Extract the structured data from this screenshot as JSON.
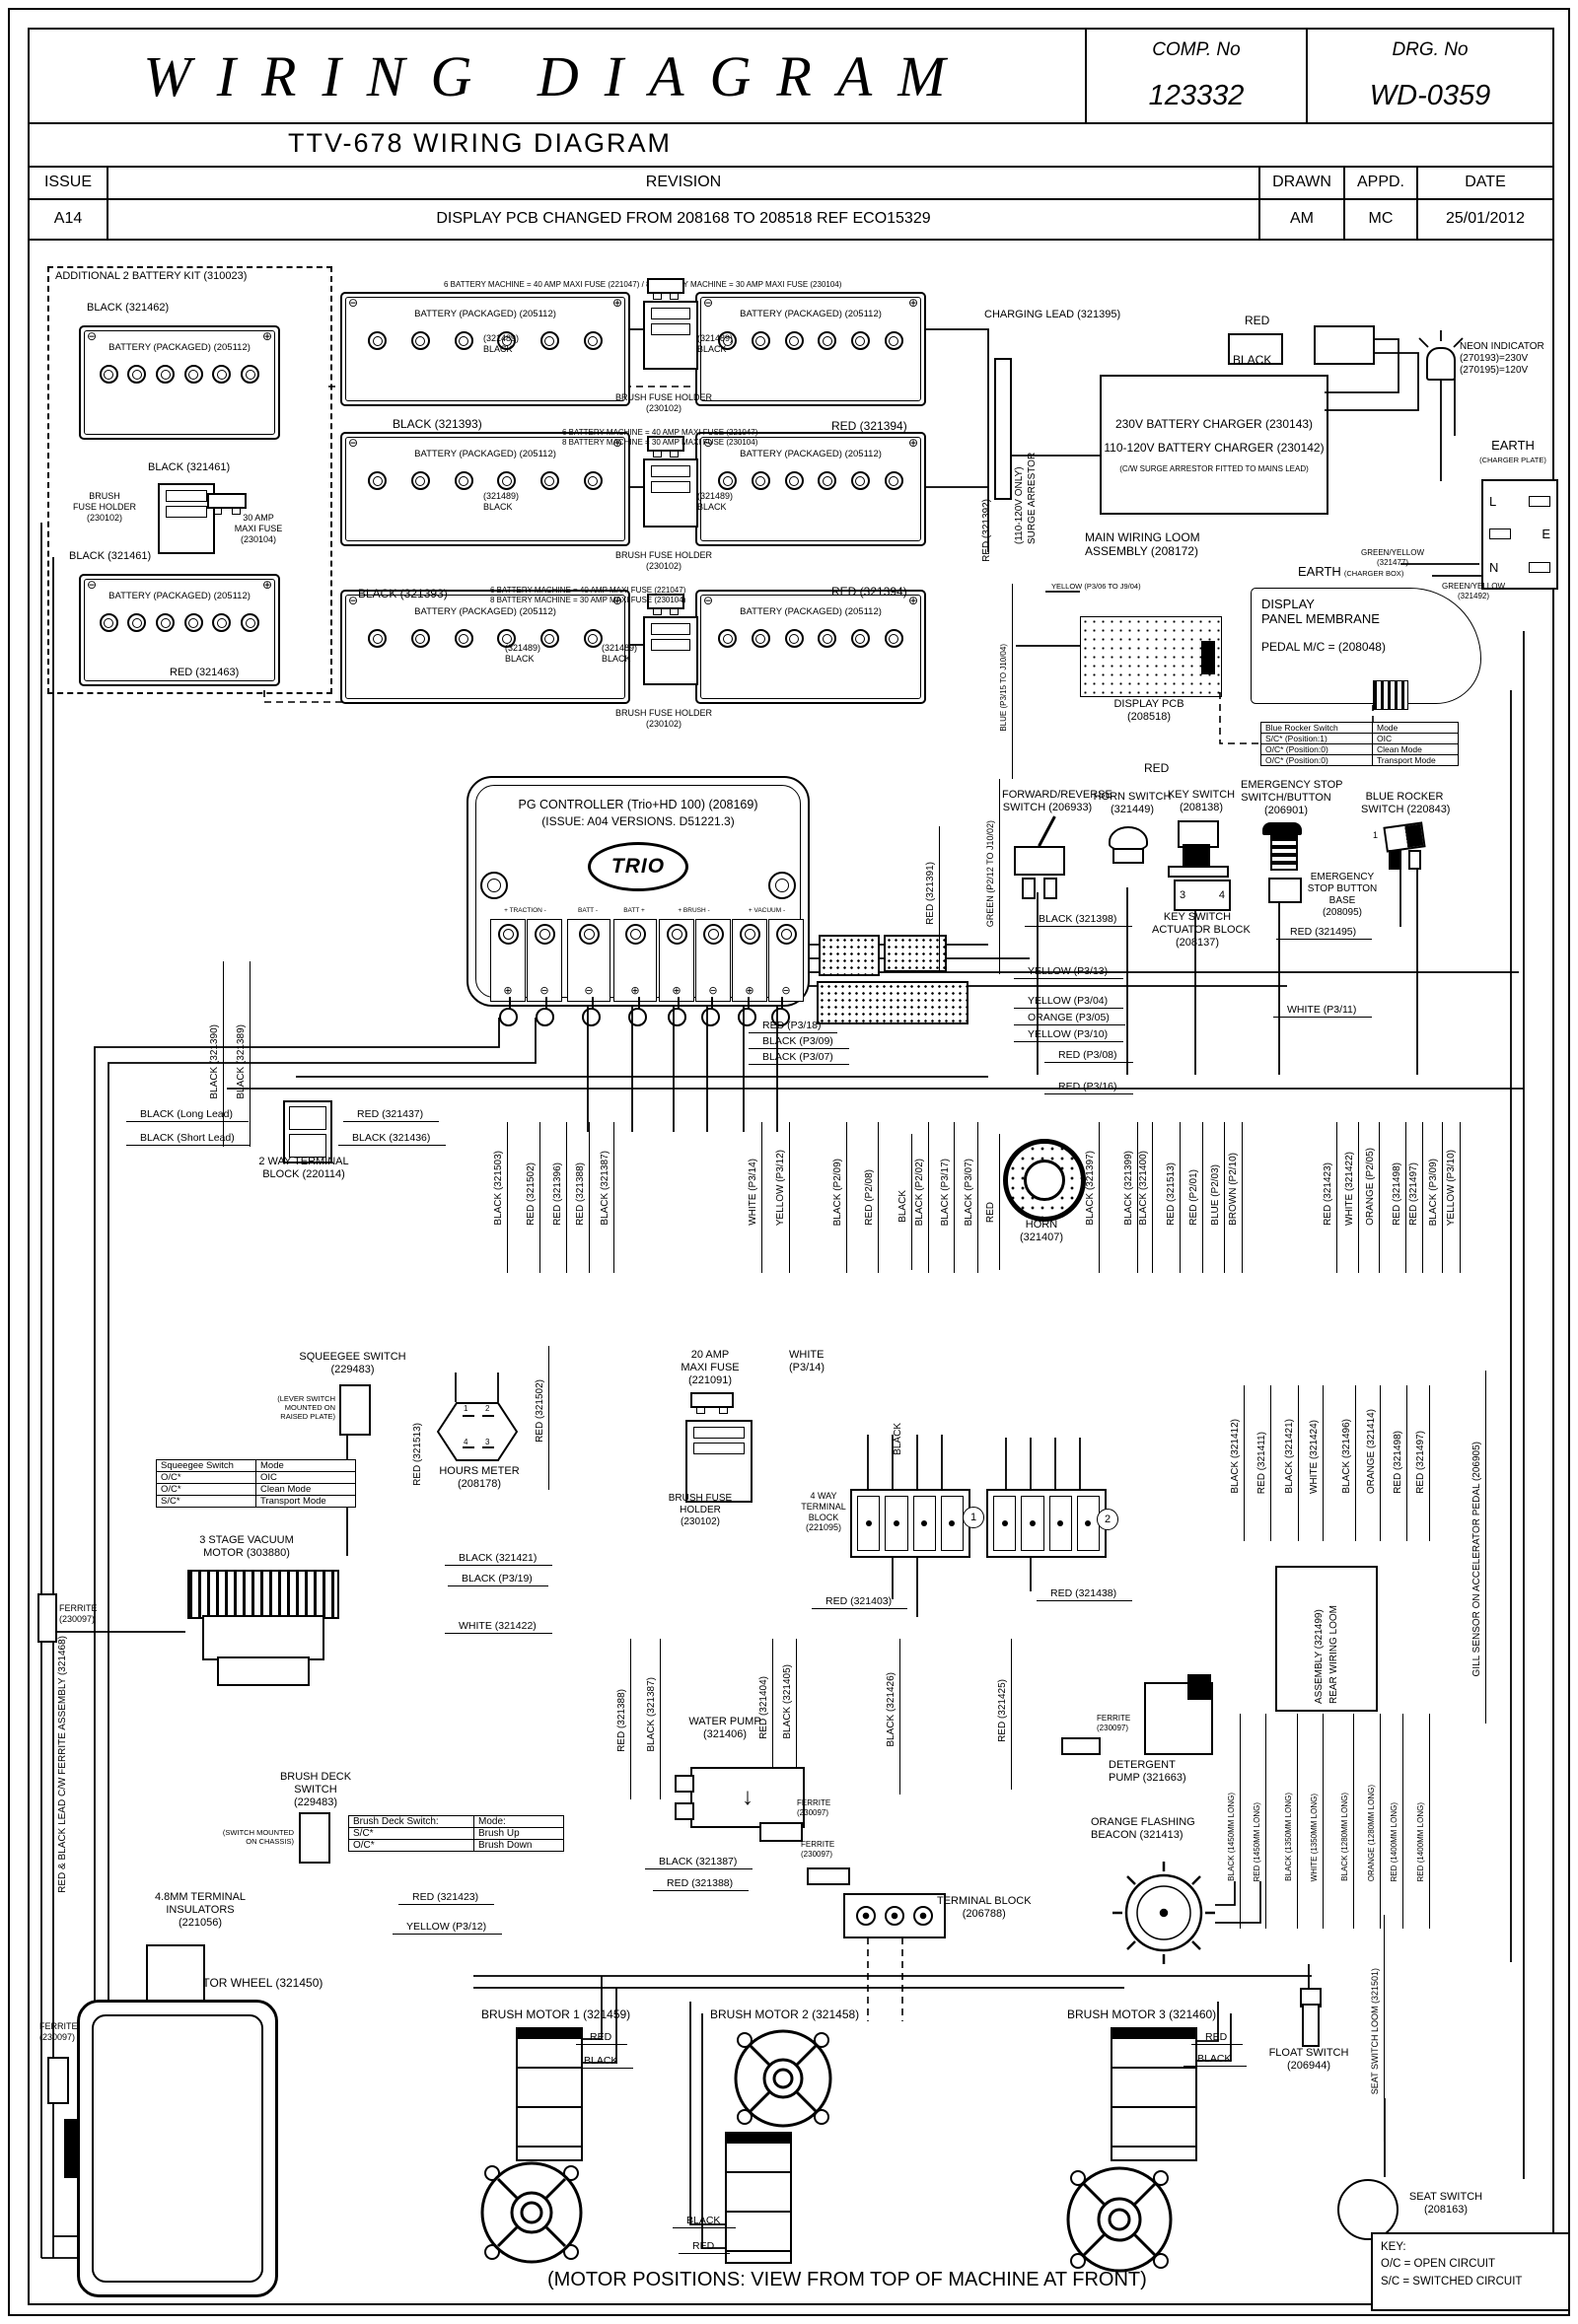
{
  "title_block": {
    "title": "WIRING DIAAGRAM_FIX",
    "comp_label": "COMP. No",
    "comp_no": "123332",
    "drg_label": "DRG. No",
    "drg_no": "WD-0359",
    "subtitle": "TTV-678 WIRING DIAGRAM"
  },
  "revision": {
    "issue_h": "ISSUE",
    "revision_h": "REVISION",
    "drawn_h": "DRAWN",
    "appd_h": "APPD.",
    "date_h": "DATE",
    "issue": "A14",
    "text": "DISPLAY PCB CHANGED FROM 208168 TO 208518 REF ECO15329",
    "drawn": "AM",
    "appd": "MC",
    "date": "25/01/2012"
  },
  "batteries": {
    "kit_title": "ADDITIONAL 2 BATTERY KIT (310023)",
    "name": "BATTERY (PACKAGED) (205112)",
    "sym_neg": "⊖",
    "sym_pos": "⊕",
    "fuse_note_combined": "6 BATTERY MACHINE = 40 AMP MAXI FUSE (221047) / 8 BATTERY MACHINE = 30 AMP MAXI FUSE (230104)",
    "fuse_note_l1": "6 BATTERY MACHINE = 40 AMP MAXI FUSE (221047)",
    "fuse_note_l2": "8 BATTERY MACHINE = 30 AMP MAXI FUSE (230104)",
    "holder_l1": "BRUSH FUSE HOLDER",
    "holder_l2": "(230102)",
    "kit_bfh_l1": "BRUSH",
    "kit_bfh_l2": "FUSE HOLDER",
    "kit_bfh_l3": "(230102)",
    "maxi30_l1": "30 AMP",
    "maxi30_l2": "MAXI FUSE",
    "maxi30_l3": "(230104)",
    "black_321462": "BLACK (321462)",
    "black_321461": "BLACK (321461)",
    "red_321463": "RED (321463)",
    "black_321393": "BLACK (321393)",
    "red_321394": "RED (321394)",
    "tag_321489": "(321489)",
    "black": "BLACK",
    "red_321392": "RED (321392)"
  },
  "charger": {
    "charging_lead": "CHARGING LEAD (321395)",
    "red": "RED",
    "black": "BLACK",
    "surge_l1": "SURGE ARRESTOR",
    "surge_l2": "(110-120V ONLY)",
    "c230": "230V BATTERY CHARGER (230143)",
    "c110": "110-120V BATTERY CHARGER (230142)",
    "note": "(C/W SURGE ARRESTOR FITTED TO MAINS LEAD)",
    "neon_l1": "NEON INDICATOR",
    "neon_l2": "(270193)=230V",
    "neon_l3": "(270195)=120V",
    "earth_plate_l1": "EARTH",
    "earth_plate_l2": "(CHARGER PLATE)",
    "earth_box_l1": "EARTH",
    "earth_box_l2": "(CHARGER BOX)",
    "l": "L",
    "e": "E",
    "n": "N",
    "gy1_l1": "GREEN/YELLOW",
    "gy1_l2": "(321477)",
    "gy2_l1": "GREEN/YELLOW",
    "gy2_l2": "(321492)",
    "loom_l1": "MAIN WIRING LOOM",
    "loom_l2": "ASSEMBLY (208172)"
  },
  "display": {
    "yellow_note": "YELLOW (P3/06 TO J9/04)",
    "blue_note": "BLUE (P3/15 TO J10/04)",
    "pcb_l1": "DISPLAY PCB",
    "pcb_l2": "(208518)",
    "mem_l1": "DISPLAY",
    "mem_l2": "PANEL MEMBRANE",
    "mem_l3": "PEDAL M/C = (208048)",
    "red": "RED",
    "tbl_h1": "Blue Rocker Switch",
    "tbl_h2": "Mode",
    "tbl_r1c1": "S/C* (Position:1)",
    "tbl_r1c2": "OIC",
    "tbl_r2c1": "O/C* (Position:0)",
    "tbl_r2c2": "Clean Mode",
    "tbl_r3c1": "O/C* (Position:0)",
    "tbl_r3c2": "Transport Mode"
  },
  "controller": {
    "title": "PG CONTROLLER (Trio+HD 100) (208169)",
    "issue": "(ISSUE: A04 VERSIONS. D51221.3)",
    "logo": "TRIO",
    "g1": "+ TRACTION -",
    "g2": "BATT -",
    "g3": "BATT +",
    "g4": "+ BRUSH -",
    "g5": "+ VACUUM -",
    "signs": [
      "⊕",
      "⊖",
      "⊖",
      "⊕",
      "⊕",
      "⊖",
      "⊕",
      "⊖"
    ],
    "red_321391": "RED (321391)"
  },
  "switches": {
    "fr_l1": "FORWARD/REVERSE",
    "fr_l2": "SWITCH (206933)",
    "horn_l1": "HORN SWITCH",
    "horn_l2": "(321449)",
    "key_l1": "KEY SWITCH",
    "key_l2": "(208138)",
    "act_l1": "KEY SWITCH",
    "act_l2": "ACTUATOR BLOCK",
    "act_l3": "(208137)",
    "pin3": "3",
    "pin4": "4",
    "es_l1": "EMERGENCY STOP",
    "es_l2": "SWITCH/BUTTON",
    "es_l3": "(206901)",
    "base_l1": "EMERGENCY",
    "base_l2": "STOP BUTTON",
    "base_l3": "BASE",
    "base_l4": "(208095)",
    "br_l1": "BLUE ROCKER",
    "br_l2": "SWITCH (220843)",
    "br_pos": "1",
    "black_321398": "BLACK (321398)",
    "red_321495": "RED (321495)",
    "green_note": "GREEN (P2/12 TO J10/02)"
  },
  "hlabels": {
    "yellow_p313": "YELLOW (P3/13)",
    "yellow_p304": "YELLOW (P3/04)",
    "orange_p305": "ORANGE (P3/05)",
    "yellow_p310": "YELLOW (P3/10)",
    "white_p311": "WHITE (P3/11)",
    "red_p308": "RED (P3/08)",
    "red_p316": "RED (P3/16)",
    "red_p318": "RED (P3/18)",
    "black_p309": "BLACK (P3/09)",
    "black_p307": "BLACK (P3/07)"
  },
  "tb2": {
    "long": "BLACK (Long Lead)",
    "short": "BLACK (Short Lead)",
    "red_321437": "RED (321437)",
    "black_321436": "BLACK (321436)",
    "name_l1": "2 WAY TERMINAL",
    "name_l2": "BLOCK (220114)"
  },
  "vwires": [
    "BLACK (321390)",
    "BLACK (321389)",
    "BLACK (321503)",
    "RED (321502)",
    "RED (321396)",
    "RED (321388)",
    "BLACK (321387)",
    "WHITE (P3/14)",
    "YELLOW (P3/12)",
    "BLACK (P2/09)",
    "RED (P2/08)",
    "BLACK",
    "BLACK (P2/02)",
    "BLACK (P3/17)",
    "BLACK (P3/07)",
    "RED",
    "BLACK (321397)",
    "BLACK (321399)",
    "BLACK (321400)",
    "RED (321513)",
    "RED (P2/01)",
    "BLUE (P2/03)",
    "BROWN (P2/10)",
    "RED (321423)",
    "WHITE (321422)",
    "ORANGE (P2/05)",
    "RED (321498)",
    "RED (321497)",
    "BLACK (P3/09)",
    "YELLOW (P3/10)"
  ],
  "horn": {
    "l1": "HORN",
    "l2": "(321407)"
  },
  "mid": {
    "sq_l1": "SQUEEGEE SWITCH",
    "sq_l2": "(229483)",
    "sq_n1": "(LEVER SWITCH",
    "sq_n2": "MOUNTED ON",
    "sq_n3": "RAISED PLATE)",
    "sqt_h1": "Squeegee Switch",
    "sqt_h2": "Mode",
    "sqt_r1c1": "O/C*",
    "sqt_r1c2": "OIC",
    "sqt_r2c1": "O/C*",
    "sqt_r2c2": "Clean Mode",
    "sqt_r3c1": "S/C*",
    "sqt_r3c2": "Transport Mode",
    "hm_l1": "HOURS METER",
    "hm_l2": "(208178)",
    "hm_p1": "1",
    "hm_p2": "2",
    "hm_p3": "3",
    "hm_p4": "4",
    "red_321513": "RED (321513)",
    "red_321502": "RED (321502)",
    "f20_l1": "20 AMP",
    "f20_l2": "MAXI FUSE",
    "f20_l3": "(221091)",
    "bfh_l1": "BRUSH FUSE",
    "bfh_l2": "HOLDER",
    "bfh_l3": "(230102)",
    "white_p314_l1": "WHITE",
    "white_p314_l2": "(P3/14)",
    "black": "BLACK",
    "tb4_l1": "4 WAY",
    "tb4_l2": "TERMINAL",
    "tb4_l3": "BLOCK",
    "tb4_l4": "(221095)",
    "n1": "1",
    "n2": "2",
    "red_321403": "RED (321403)",
    "red_321438": "RED (321438)",
    "vac_l1": "3 STAGE VACUUM",
    "vac_l2": "MOTOR (303880)",
    "fer_l1": "FERRITE",
    "fer_l2": "(230097)",
    "black_321421": "BLACK (321421)",
    "black_p319": "BLACK (P3/19)",
    "white_321422": "WHITE (321422)"
  },
  "rightmid": {
    "v": [
      "BLACK (321412)",
      "RED (321411)",
      "BLACK (321421)",
      "WHITE (321424)",
      "BLACK (321496)",
      "ORANGE (321414)",
      "RED (321498)",
      "RED (321497)"
    ],
    "loom_l1": "REAR WIRING LOOM",
    "loom_l2": "ASSEMBLY (321499)",
    "gill": "GILL SENSOR ON ACCELERATOR PEDAL (206905)"
  },
  "pumps": {
    "wp_l1": "WATER PUMP",
    "wp_l2": "(321406)",
    "v_red388": "RED (321388)",
    "v_black387": "BLACK (321387)",
    "v_red404": "RED (321404)",
    "v_black405": "BLACK (321405)",
    "v_black426": "BLACK (321426)",
    "v_red425": "RED (321425)",
    "h_black387": "BLACK (321387)",
    "h_red388": "RED (321388)",
    "fer_l1": "FERRITE",
    "fer_l2": "(230097)",
    "tb_l1": "TERMINAL BLOCK",
    "tb_l2": "(206788)",
    "det_l1": "DETERGENT",
    "det_l2": "PUMP (321663)",
    "bea_l1": "ORANGE FLASHING",
    "bea_l2": "BEACON (321413)",
    "lengths": [
      "BLACK (1450MM LONG)",
      "RED (1450MM LONG)",
      "BLACK (1350MM LONG)",
      "WHITE (1350MM LONG)",
      "BLACK (1280MM LONG)",
      "ORANGE (1280MM LONG)",
      "RED (1400MM LONG)",
      "RED (1400MM LONG)"
    ]
  },
  "deck": {
    "bds_l1": "BRUSH DECK",
    "bds_l2": "SWITCH",
    "bds_l3": "(229483)",
    "n1": "(SWITCH MOUNTED",
    "n2": "ON CHASSIS)",
    "t_h1": "Brush Deck Switch:",
    "t_h2": "Mode:",
    "t_r1c1": "S/C*",
    "t_r1c2": "Brush Up",
    "t_r2c1": "O/C*",
    "t_r2c2": "Brush Down",
    "ins_l1": "4.8MM TERMINAL",
    "ins_l2": "INSULATORS",
    "ins_l3": "(221056)",
    "red_321423": "RED (321423)",
    "yellow_p312": "YELLOW (P3/12)"
  },
  "bottom": {
    "wheel": "MOTOR WHEEL (321450)",
    "fer_l1": "FERRITE",
    "fer_l2": "(230097)",
    "bm1": "BRUSH MOTOR 1 (321459)",
    "bm2": "BRUSH MOTOR 2 (321458)",
    "bm3": "BRUSH MOTOR 3 (321460)",
    "red": "RED",
    "black": "BLACK",
    "float_l1": "FLOAT SWITCH",
    "float_l2": "(206944)",
    "seat_loom": "SEAT SWITCH LOOM (321501)",
    "seat_l1": "SEAT SWITCH",
    "seat_l2": "(208163)",
    "key_t": "KEY:",
    "key_1": "O/C = OPEN CIRCUIT",
    "key_2": "S/C = SWITCHED CIRCUIT",
    "footer": "(MOTOR POSITIONS: VIEW FROM TOP OF MACHINE AT FRONT)"
  },
  "left_note": "RED & BLACK LEAD C/W FERRITE ASSEMBLY (321468)"
}
